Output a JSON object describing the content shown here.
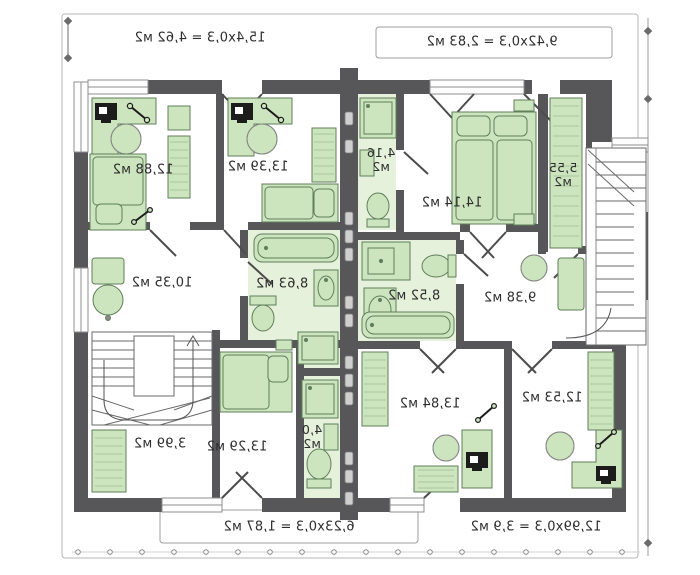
{
  "plan": {
    "title": "first-floor-plan-mirrored",
    "dimension_labels": {
      "top_left": "15,4x0,3 = 4,62 м2",
      "top_right": "9,42x0,3 = 2,83 м2",
      "bottom_left": "6,23x0,3 = 1,87 м2",
      "bottom_right": "12,99x0,3 = 3,9 м2"
    },
    "rooms": [
      {
        "id": "bedroom-top-left",
        "label": "12,88 м2"
      },
      {
        "id": "bedroom-top-mid",
        "label": "13,39 м2"
      },
      {
        "id": "hall-left",
        "label": "10,35 м2"
      },
      {
        "id": "bathroom-left",
        "label": "8,63 м2"
      },
      {
        "id": "wc-top",
        "label": "4,16",
        "label2": "м2"
      },
      {
        "id": "bedroom-right",
        "label": "14,14 м2"
      },
      {
        "id": "closet-right",
        "label": "5,55",
        "label2": "м2"
      },
      {
        "id": "bathroom-right",
        "label": "8,52 м2"
      },
      {
        "id": "hall-right",
        "label": "9,38 м2"
      },
      {
        "id": "storage-left",
        "label": "3,99 м2"
      },
      {
        "id": "bedroom-bottom-left",
        "label": "13,29 м2"
      },
      {
        "id": "wc-bottom",
        "label": "4,0",
        "label2": "м2"
      },
      {
        "id": "bedroom-bottom-mid",
        "label": "13,84 м2"
      },
      {
        "id": "bedroom-bottom-right",
        "label": "12,53 м2"
      }
    ],
    "colors": {
      "wall": "#57575a",
      "furniture_fill": "#cde5bf",
      "furniture_stroke": "#5f7f5a",
      "floor_tint": "#e6f1dc",
      "outline": "#9a9a9a"
    }
  }
}
